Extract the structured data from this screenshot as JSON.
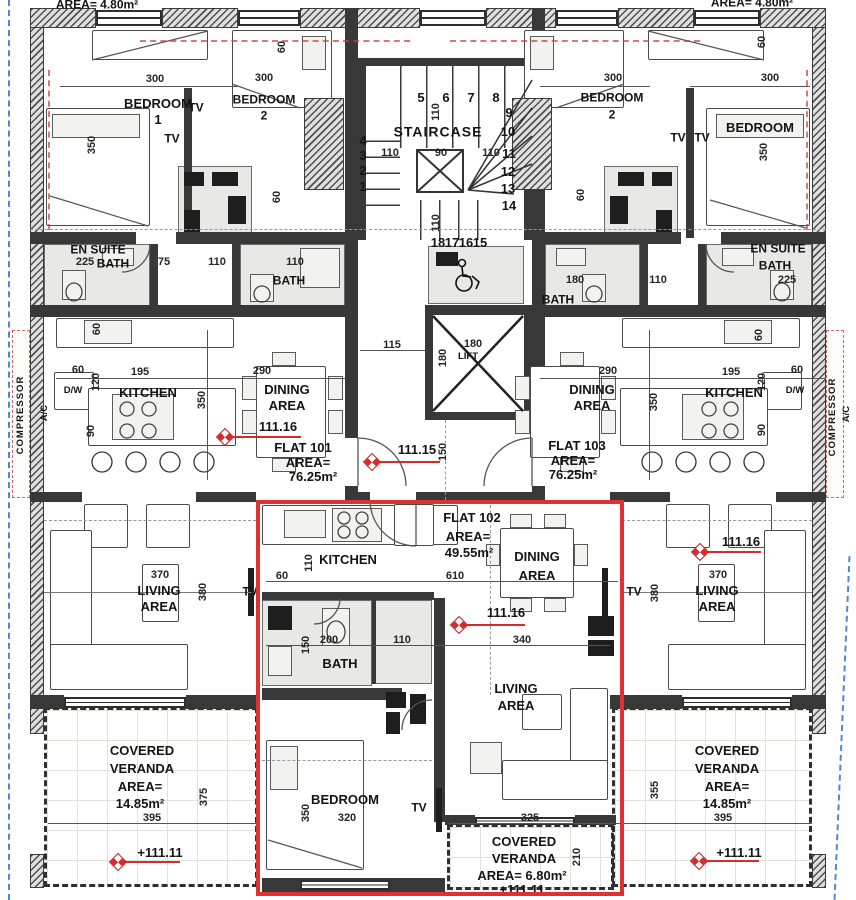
{
  "site": {
    "top_left_area": "AREA= 4.80m²",
    "top_right_area": "AREA= 4.80m²"
  },
  "core": {
    "staircase_label": "STAIRCASE",
    "lift_label": "LIFT",
    "hall_level": "111.15",
    "steps": {
      "top": [
        "5",
        "6",
        "7",
        "8"
      ],
      "right": [
        "9",
        "10",
        "11",
        "12",
        "13",
        "14"
      ],
      "left": [
        "4",
        "3",
        "2",
        "1"
      ],
      "bottom": [
        "18",
        "17",
        "16",
        "15"
      ]
    },
    "dims": {
      "flight_left": "110",
      "mid": "90",
      "flight_right": "110",
      "riser_top": "110",
      "riser_bottom": "110",
      "lobby_width": "115",
      "lift_w": "180",
      "lift_h": "180",
      "corridor_right": "180",
      "hall_depth": "150"
    }
  },
  "flat101": {
    "name": "FLAT 101",
    "area_label": "AREA=",
    "area_value": "76.25m²",
    "level": "111.16",
    "bedroom1": {
      "line1": "BEDROOM",
      "line2": "1",
      "dim_w": "300",
      "dim_h": "350",
      "tv": "TV"
    },
    "bedroom2": {
      "line1": "BEDROOM",
      "line2": "2",
      "dim_w": "300",
      "tv": "TV",
      "closet_dim_a": "60",
      "closet_dim_b": "60"
    },
    "ensuite": {
      "line1": "EN SUITE",
      "line2": "BATH",
      "dim_a": "225",
      "dim_b": "75"
    },
    "bath": {
      "label": "BATH",
      "dim_a": "110",
      "dim_b": "110"
    },
    "kitchen": {
      "label": "KITCHEN",
      "dw": "D/W",
      "dim_w": "195",
      "dim_a": "60",
      "dim_b": "60",
      "dim_c": "120",
      "dim_d": "90"
    },
    "dining": {
      "line1": "DINING",
      "line2": "AREA",
      "dim_w": "290",
      "dim_h": "350"
    },
    "living": {
      "line1": "LIVING",
      "line2": "AREA",
      "dim_w": "370",
      "dim_h": "380",
      "tv": "TV"
    },
    "veranda": {
      "line1": "COVERED",
      "line2": "VERANDA",
      "line3": "AREA=",
      "line4": "14.85m²",
      "dim_w": "395",
      "dim_h": "375",
      "level": "+111.11"
    }
  },
  "flat102": {
    "name": "FLAT 102",
    "area_label": "AREA=",
    "area_value": "49.55m²",
    "level": "111.16",
    "kitchen": {
      "label": "KITCHEN",
      "dim_w": "610",
      "dim_a": "110",
      "dim_b": "60"
    },
    "dining": {
      "line1": "DINING",
      "line2": "AREA",
      "dim": "340"
    },
    "bath": {
      "label": "BATH",
      "dim_a": "200",
      "dim_b": "110",
      "dim_c": "150"
    },
    "living": {
      "line1": "LIVING",
      "line2": "AREA"
    },
    "bedroom": {
      "label": "BEDROOM",
      "dim_w": "320",
      "dim_h": "350",
      "tv": "TV"
    },
    "veranda": {
      "line1": "COVERED",
      "line2": "VERANDA",
      "line3": "AREA= 6.80m²",
      "level": "+111.11",
      "dim_w": "325",
      "dim_h": "210"
    }
  },
  "flat103": {
    "name": "FLAT 103",
    "area_label": "AREA=",
    "area_value": "76.25m²",
    "level": "111.16",
    "bedroom2": {
      "line1": "BEDROOM",
      "line2": "2",
      "dim_w": "300",
      "tv": "TV",
      "closet_dim_a": "60",
      "closet_dim_b": "60"
    },
    "bedroom": {
      "line1": "BEDROOM",
      "dim_w": "300",
      "dim_h": "350",
      "tv": "TV"
    },
    "ensuite": {
      "line1": "EN SUITE",
      "line2": "BATH",
      "dim_a": "225"
    },
    "bath": {
      "label": "BATH",
      "dim_a": "110"
    },
    "kitchen": {
      "label": "KITCHEN",
      "dw": "D/W",
      "dim_w": "195",
      "dim_a": "60",
      "dim_b": "60",
      "dim_c": "120",
      "dim_d": "90"
    },
    "dining": {
      "line1": "DINING",
      "line2": "AREA",
      "dim_w": "290",
      "dim_h": "350"
    },
    "living": {
      "line1": "LIVING",
      "line2": "AREA",
      "dim_w": "370",
      "dim_h": "380",
      "tv": "TV"
    },
    "veranda": {
      "line1": "COVERED",
      "line2": "VERANDA",
      "line3": "AREA=",
      "line4": "14.85m²",
      "dim_w": "395",
      "dim_h": "355",
      "level": "+111.11"
    }
  },
  "services": {
    "compressor_left": "COMPRESSOR",
    "ac_left": "A/C",
    "compressor_right": "COMPRESSOR",
    "ac_right": "A/C"
  }
}
